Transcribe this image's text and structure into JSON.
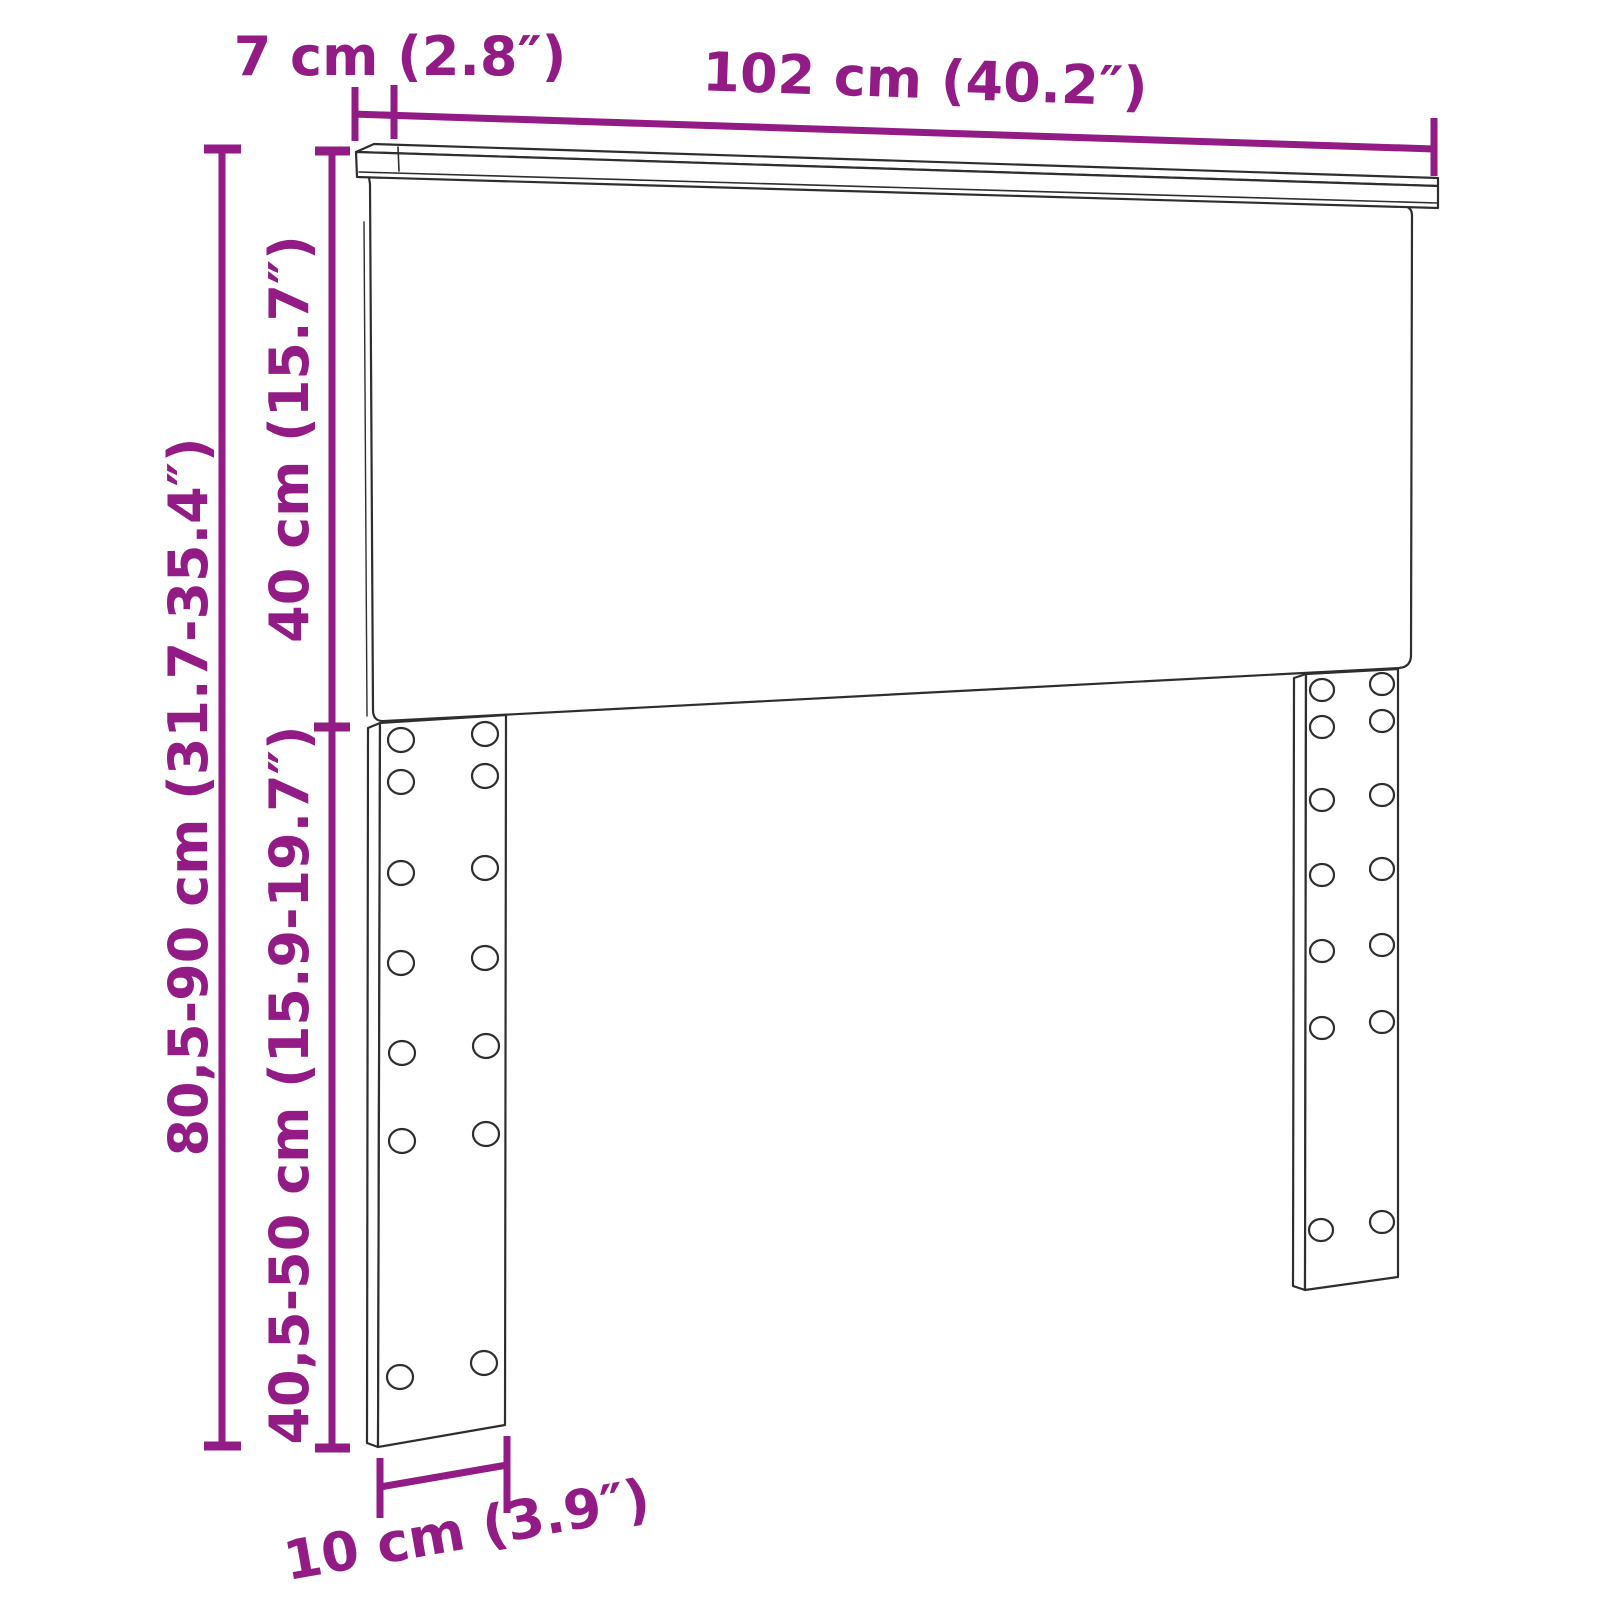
{
  "colors": {
    "dimension": "#921b86",
    "outline": "#2e2e2e",
    "background": "#ffffff"
  },
  "labels": {
    "shelf_depth": "7 cm (2.8″)",
    "width": "102 cm (40.2″)",
    "panel_height": "40 cm (15.7″)",
    "total_height": "80,5-90 cm (31.7-35.4″)",
    "leg_height": "40,5-50 cm (15.9-19.7″)",
    "leg_width": "10 cm (3.9″)"
  }
}
